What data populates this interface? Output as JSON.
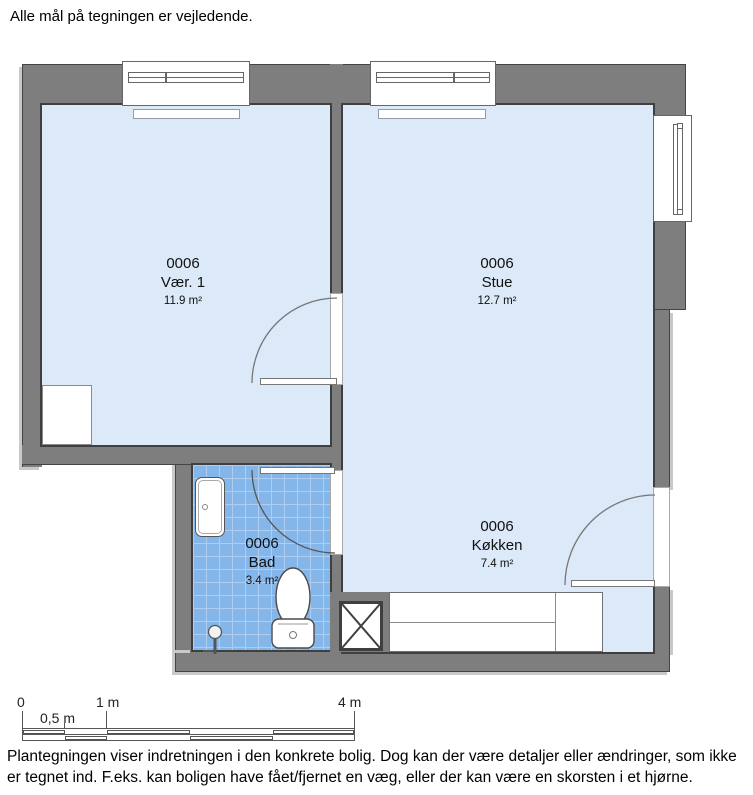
{
  "header": {
    "note": "Alle mål på tegningen er vejledende."
  },
  "unit_id": "0006",
  "rooms": [
    {
      "id": "0006",
      "name": "Vær. 1",
      "area": "11.9 m²"
    },
    {
      "id": "0006",
      "name": "Stue",
      "area": "12.7 m²"
    },
    {
      "id": "0006",
      "name": "Bad",
      "area": "3.4 m²"
    },
    {
      "id": "0006",
      "name": "Køkken",
      "area": "7.4 m²"
    }
  ],
  "scale_bar": {
    "labels": [
      "0",
      "0,5 m",
      "1 m",
      "4 m"
    ]
  },
  "footer": {
    "lines": [
      "Plantegningen viser indretningen i den konkrete bolig. Dog kan der være detaljer eller ændringer, som ikke",
      "er tegnet ind. F.eks. kan boligen have fået/fjernet en væg, eller der kan være en skorsten i et hjørne."
    ]
  },
  "colors": {
    "wall": "#7e7e7e",
    "wall_outline": "#3f3f3f",
    "floor": "#dbe9f8",
    "bath_tile": "#85b6ea",
    "bath_tile_grid": "#aecdf1"
  }
}
